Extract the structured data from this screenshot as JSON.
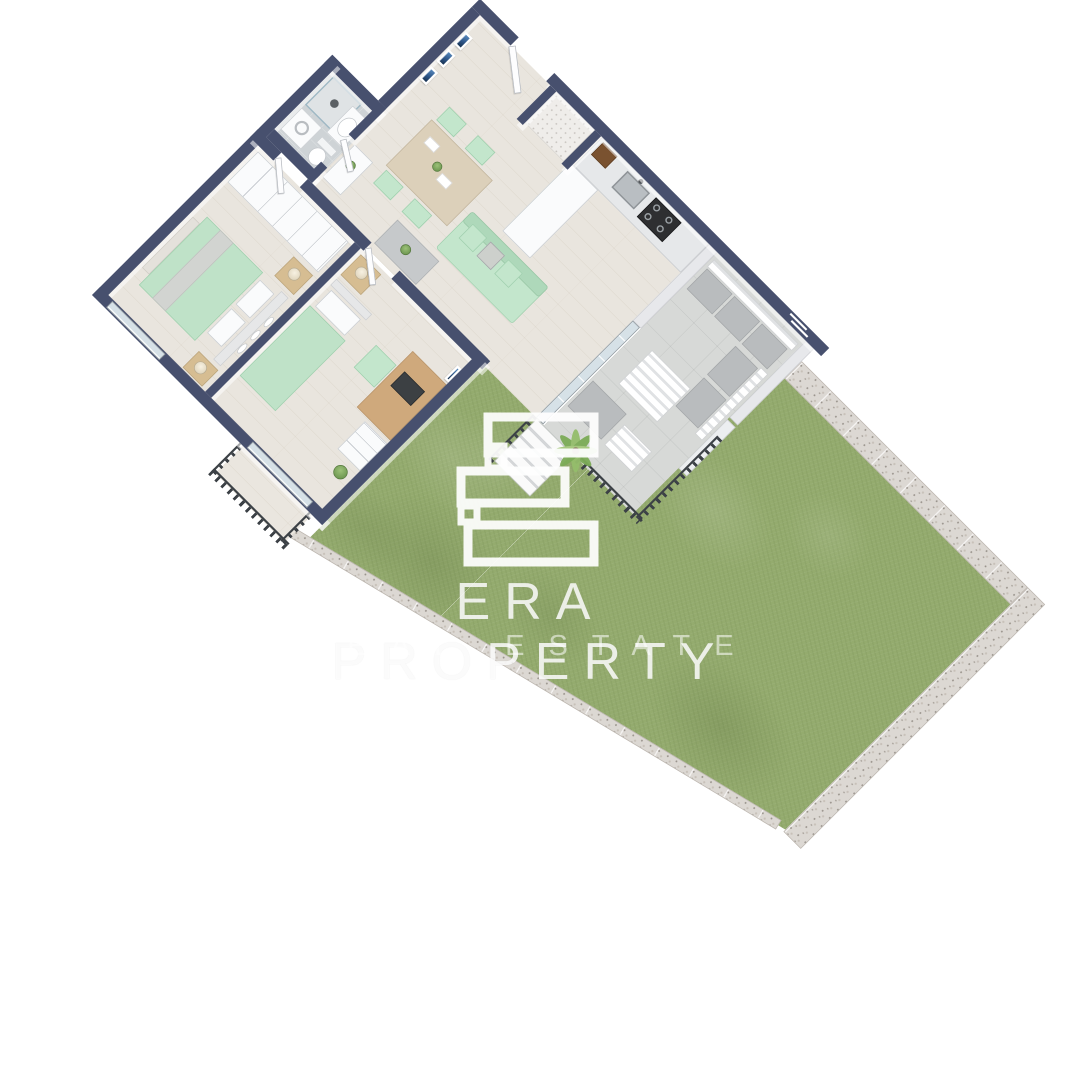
{
  "watermark": {
    "logo_letter": "E",
    "brand_line1": "ERA PROPERTY",
    "brand_line2": "REAL ESTATE"
  },
  "colors": {
    "wall": "#47506e",
    "grass": "#94ab6e",
    "gabion": "#dcd8d3",
    "wood": "#e9e5de",
    "bathtile": "#ced3d6",
    "terracetile": "#d7d9d7",
    "glass": "#d6e1e7",
    "railing": "#3c4146",
    "mint": "#c3e6cc",
    "furnwood": "#d6bd92",
    "counter": "#e6e8ea",
    "stove": "#2e2f31"
  },
  "scene": {
    "type": "isometric-3d-floor-plan-render",
    "view": "top-down cutaway apartment with private garden",
    "rooms": [
      {
        "name": "entrance-hall",
        "furniture": [
          "entry-door",
          "wall-art-frames",
          "storage-niche"
        ]
      },
      {
        "name": "kitchen",
        "furniture": [
          "l-shaped-counter",
          "sink",
          "gas-stove",
          "tall-cabinet",
          "spice-rack"
        ]
      },
      {
        "name": "living-dining-room",
        "furniture": [
          "dining-table",
          "four-mint-chairs",
          "mint-sofa",
          "coffee-table",
          "sideboard"
        ]
      },
      {
        "name": "bathroom",
        "furniture": [
          "shower",
          "vanity-sink",
          "toilet",
          "washing-machine"
        ]
      },
      {
        "name": "master-bedroom",
        "furniture": [
          "sliding-wardrobe",
          "double-bed-mint-bedding",
          "two-nightstands",
          "lamps",
          "wall-mirrors",
          "foot-bench"
        ]
      },
      {
        "name": "second-bedroom",
        "furniture": [
          "single-bed-mint-bedding",
          "nightstand",
          "desk-with-laptop",
          "mint-chair",
          "drawer-unit",
          "plant",
          "wall-art"
        ]
      },
      {
        "name": "terrace",
        "furniture": [
          "outdoor-bench-gray-cushions",
          "slatted-coffee-table",
          "low-table",
          "palm-plant",
          "dark-railing",
          "steps-to-garden"
        ]
      },
      {
        "name": "french-balcony",
        "furniture": [
          "dark-railing",
          "glass-door"
        ]
      },
      {
        "name": "garden",
        "furniture": [
          "lawn",
          "gabion-stone-walls"
        ]
      }
    ]
  }
}
